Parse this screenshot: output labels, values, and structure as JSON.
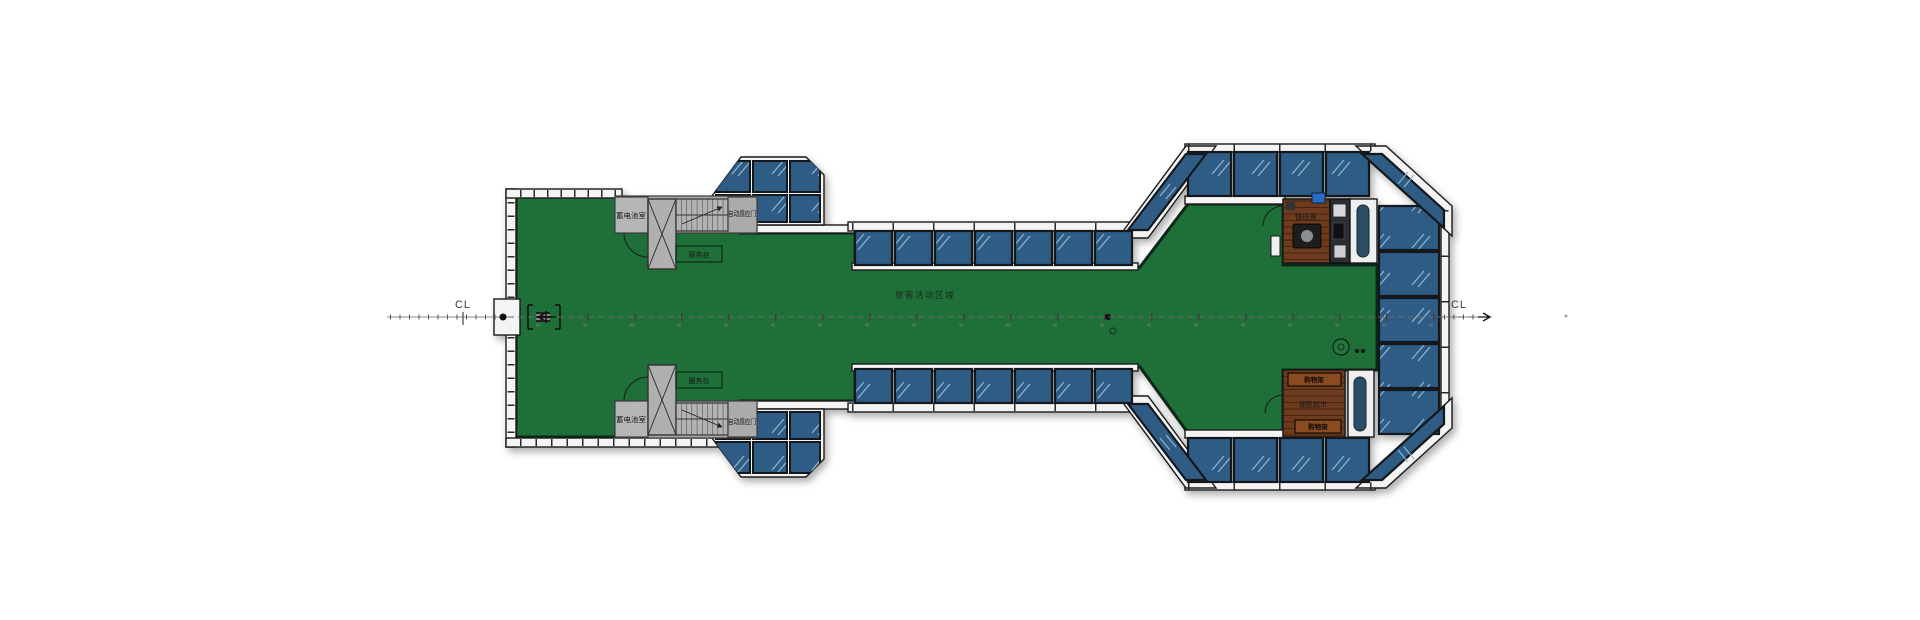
{
  "centerline": {
    "left_label": "CL",
    "right_label": "CL"
  },
  "labels": {
    "main_area": "旅客活动区域",
    "service_desk_top": "服务台",
    "service_desk_bottom": "服务台",
    "battery_room_top": "蓄电池室",
    "battery_room_bottom": "蓄电池室",
    "auto_door_top": "自动感应门",
    "auto_door_bottom": "自动感应门",
    "duty_room": "值班室",
    "shelf_top": "购物架",
    "shelf_bottom": "购物架",
    "shop_area": "便民超市"
  },
  "colors": {
    "floor_green": "#1f6f38",
    "floor_edge": "#0c2617",
    "room_blue": "#2e5c85",
    "glass_line": "#8fb4d2",
    "wall_white": "#f4f4f4",
    "wall_dark": "#14181c",
    "core_gray": "#acacac",
    "wood_brown": "#6e3b1e",
    "shelf_brown": "#8a4a22",
    "centerline_gray": "#6a6a6a"
  }
}
